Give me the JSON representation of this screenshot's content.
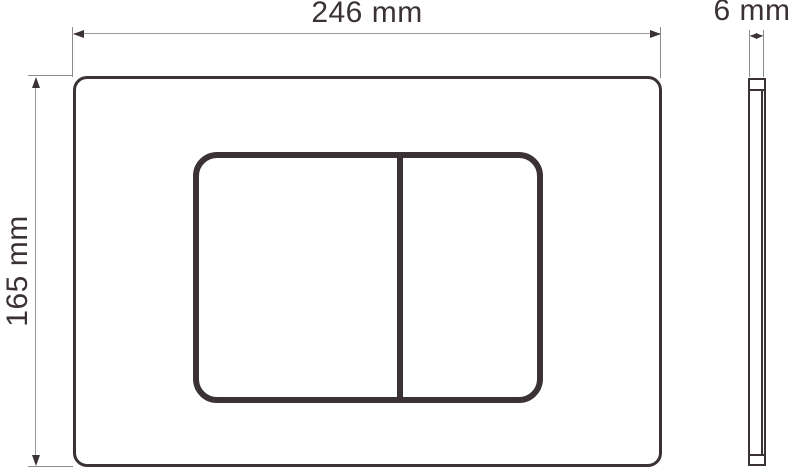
{
  "drawing": {
    "type": "technical-dimension-drawing",
    "subject": "dual-flush toilet actuator plate",
    "views": {
      "front": {
        "name": "front view",
        "elements": [
          "plate outline",
          "button panel",
          "button divider",
          "left button",
          "right button"
        ]
      },
      "side": {
        "name": "side profile view",
        "elements": [
          "plate edge profile"
        ]
      }
    },
    "dimensions": {
      "width": {
        "label": "246 mm",
        "value": 246,
        "unit": "mm",
        "applies_to": "plate width"
      },
      "height": {
        "label": "165 mm",
        "value": 165,
        "unit": "mm",
        "applies_to": "plate height"
      },
      "thickness": {
        "label": "6 mm",
        "value": 6,
        "unit": "mm",
        "applies_to": "plate thickness"
      }
    },
    "colors": {
      "outline": "#3a3234",
      "dimension_line": "#9a9a9a",
      "extension_line": "#8c8c8c",
      "background": "#ffffff"
    }
  }
}
